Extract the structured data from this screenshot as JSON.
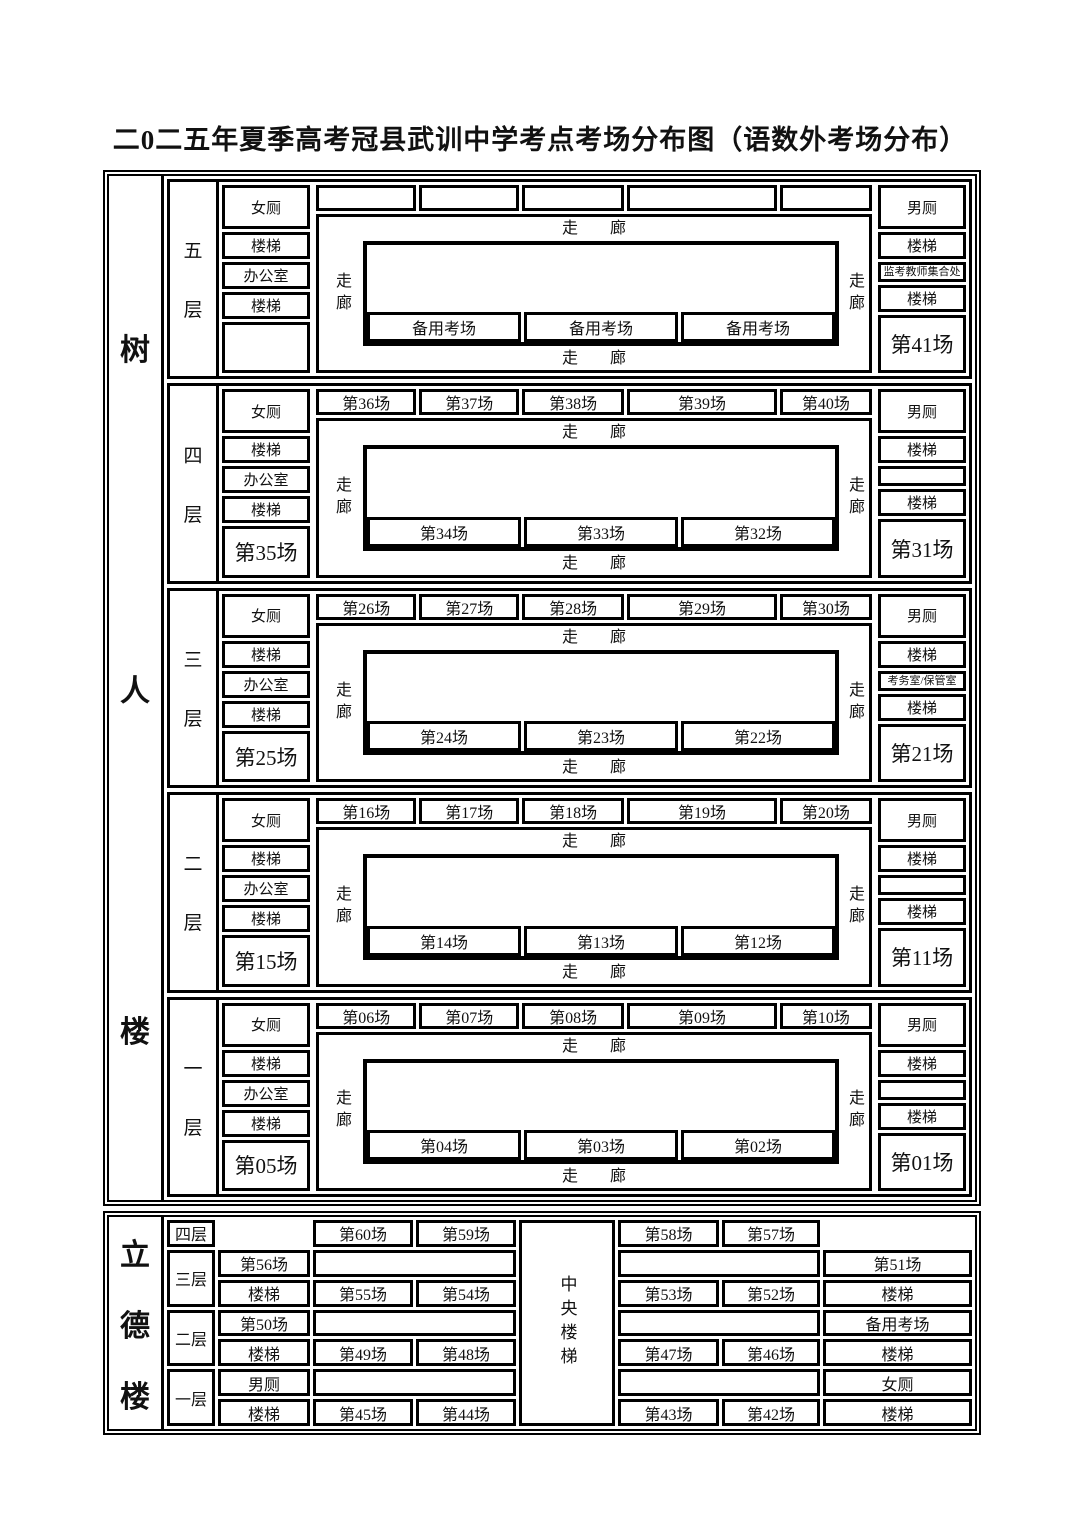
{
  "title": "二0二五年夏季高考冠县武训中学考点考场分布图（语数外考场分布）",
  "colors": {
    "ink": "#000000",
    "background": "#ffffff"
  },
  "b1": {
    "name": "树人楼",
    "corr_h": "走　　廊",
    "corr_v": "走廊",
    "floors": [
      {
        "label": "五层",
        "left": [
          "女厕",
          "楼梯",
          "办公室",
          "楼梯",
          ""
        ],
        "top": [
          "",
          "",
          "",
          "",
          ""
        ],
        "inner": [
          "备用考场",
          "备用考场",
          "备用考场"
        ],
        "right": [
          "男厕",
          "楼梯",
          "监考教师集合处",
          "楼梯",
          "第41场"
        ]
      },
      {
        "label": "四层",
        "left": [
          "女厕",
          "楼梯",
          "办公室",
          "楼梯",
          "第35场"
        ],
        "top": [
          "第36场",
          "第37场",
          "第38场",
          "第39场",
          "第40场"
        ],
        "inner": [
          "第34场",
          "第33场",
          "第32场"
        ],
        "right": [
          "男厕",
          "楼梯",
          "",
          "楼梯",
          "第31场"
        ]
      },
      {
        "label": "三层",
        "left": [
          "女厕",
          "楼梯",
          "办公室",
          "楼梯",
          "第25场"
        ],
        "top": [
          "第26场",
          "第27场",
          "第28场",
          "第29场",
          "第30场"
        ],
        "inner": [
          "第24场",
          "第23场",
          "第22场"
        ],
        "right": [
          "男厕",
          "楼梯",
          "考务室/保管室",
          "楼梯",
          "第21场"
        ]
      },
      {
        "label": "二层",
        "left": [
          "女厕",
          "楼梯",
          "办公室",
          "楼梯",
          "第15场"
        ],
        "top": [
          "第16场",
          "第17场",
          "第18场",
          "第19场",
          "第20场"
        ],
        "inner": [
          "第14场",
          "第13场",
          "第12场"
        ],
        "right": [
          "男厕",
          "楼梯",
          "",
          "楼梯",
          "第11场"
        ]
      },
      {
        "label": "一层",
        "left": [
          "女厕",
          "楼梯",
          "办公室",
          "楼梯",
          "第05场"
        ],
        "top": [
          "第06场",
          "第07场",
          "第08场",
          "第09场",
          "第10场"
        ],
        "inner": [
          "第04场",
          "第03场",
          "第02场"
        ],
        "right": [
          "男厕",
          "楼梯",
          "",
          "楼梯",
          "第01场"
        ]
      }
    ]
  },
  "b2": {
    "name": "立德楼",
    "central": "中央楼梯",
    "floors": [
      "四层",
      "三层",
      "二层",
      "一层"
    ],
    "c1": [
      "第56场",
      "楼梯",
      "第50场",
      "楼梯",
      "男厕",
      "楼梯"
    ],
    "r1": [
      "第60场",
      "第59场",
      "第58场",
      "第57场"
    ],
    "r3": [
      "第55场",
      "第54场",
      "第53场",
      "第52场"
    ],
    "r5": [
      "第49场",
      "第48场",
      "第47场",
      "第46场"
    ],
    "r7": [
      "第45场",
      "第44场",
      "第43场",
      "第42场"
    ],
    "right": [
      "第51场",
      "楼梯",
      "备用考场",
      "楼梯",
      "女厕",
      "楼梯"
    ]
  }
}
